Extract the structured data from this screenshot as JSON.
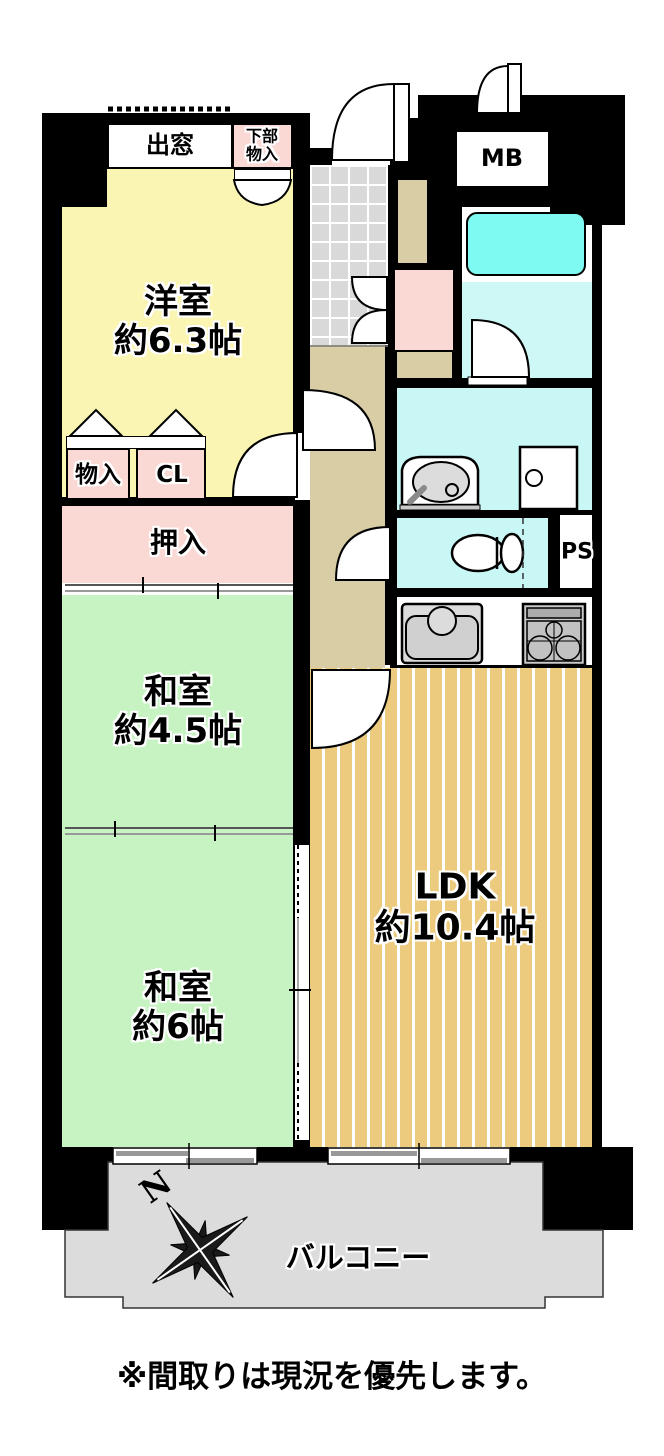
{
  "rooms": {
    "western": {
      "name": "洋室",
      "size": "約6.3帖"
    },
    "japanese45": {
      "name": "和室",
      "size": "約4.5帖"
    },
    "japanese6": {
      "name": "和室",
      "size": "約6帖"
    },
    "ldk": {
      "name": "LDK",
      "size": "約10.4帖"
    },
    "balcony": {
      "name": "バルコニー"
    }
  },
  "storage": {
    "oshiire": "押入",
    "monoire": "物入",
    "closet": "CL",
    "lower_storage_l1": "下部",
    "lower_storage_l2": "物入",
    "bay_window": "出窓"
  },
  "utility": {
    "meter_box": "MB",
    "pipe_space": "PS"
  },
  "compass": {
    "north_label": "N"
  },
  "note": "※間取りは現況を優先します。",
  "colors": {
    "western_room": "#FBF5B4",
    "japanese_room": "#C7F3C3",
    "storage_pink": "#FAD8D4",
    "wet_area_cyan": "#C9F7F5",
    "bathtub_cyan": "#7EFAF2",
    "ldk_floor": "#ECCA7E",
    "hallway_tan": "#D8CDA4",
    "balcony_gray": "#DCDCDC",
    "entry_tile": "#D9D9D9",
    "walls": "#000000"
  }
}
